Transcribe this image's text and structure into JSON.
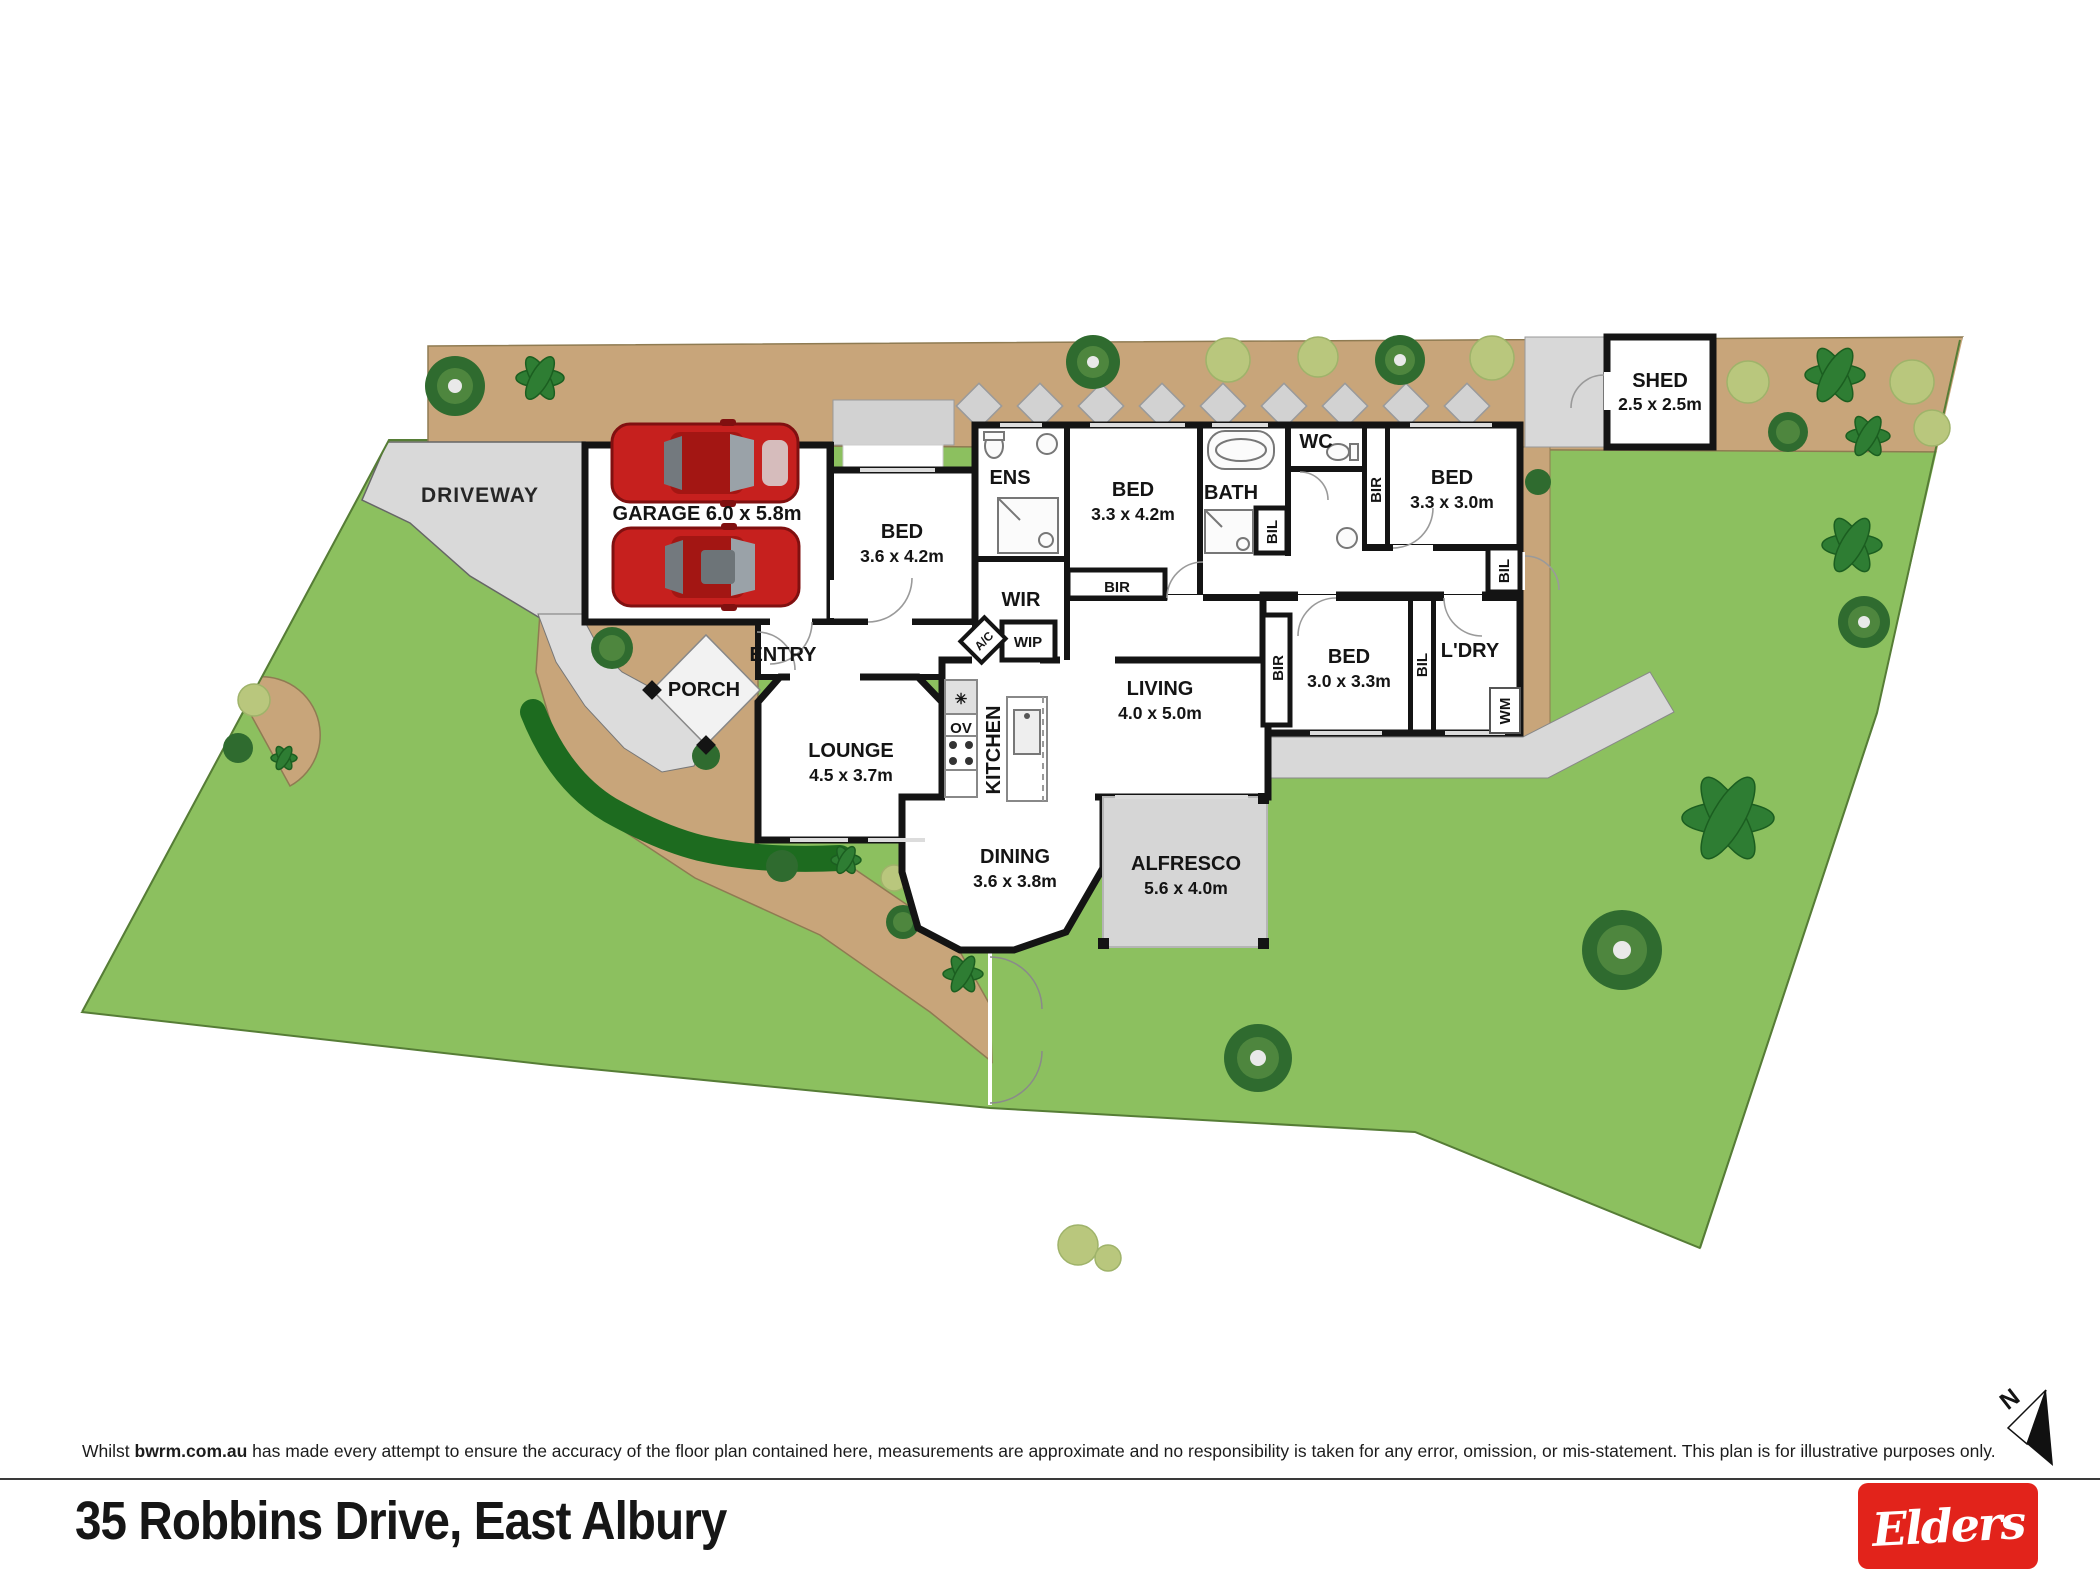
{
  "site": {
    "driveway_label": "DRIVEWAY",
    "colors": {
      "lawn": "#8cc05f",
      "garden_bed": "#c8a57a",
      "paving": "#d9d9d9",
      "alfresco": "#d6d6d6",
      "wall": "#141414",
      "brand_red": "#e2231b"
    }
  },
  "rooms": {
    "garage": {
      "label": "GARAGE 6.0 x 5.8m"
    },
    "porch": {
      "label": "PORCH"
    },
    "entry": {
      "label": "ENTRY"
    },
    "bed1": {
      "name": "BED",
      "dims": "3.6 x 4.2m"
    },
    "ens": {
      "label": "ENS"
    },
    "wir": {
      "label": "WIR"
    },
    "wip": {
      "label": "WIP"
    },
    "ac": {
      "label": "A/C"
    },
    "bed2": {
      "name": "BED",
      "dims": "3.3 x 4.2m"
    },
    "bir_bed2": {
      "label": "BIR"
    },
    "bath": {
      "label": "BATH"
    },
    "bil_bath": {
      "label": "BIL"
    },
    "wc": {
      "label": "WC"
    },
    "bir_bed3": {
      "label": "BIR"
    },
    "bed3": {
      "name": "BED",
      "dims": "3.3 x 3.0m"
    },
    "bil_hall": {
      "label": "BIL"
    },
    "lounge": {
      "name": "LOUNGE",
      "dims": "4.5 x 3.7m"
    },
    "kitchen": {
      "label": "KITCHEN"
    },
    "ov": {
      "label": "OV"
    },
    "living": {
      "name": "LIVING",
      "dims": "4.0 x 5.0m"
    },
    "bir_bed4": {
      "label": "BIR"
    },
    "bed4": {
      "name": "BED",
      "dims": "3.0 x 3.3m"
    },
    "bil_ldry": {
      "label": "BIL"
    },
    "ldry": {
      "label": "L'DRY"
    },
    "wm": {
      "label": "WM"
    },
    "dining": {
      "name": "DINING",
      "dims": "3.6 x 3.8m"
    },
    "alfresco": {
      "name": "ALFRESCO",
      "dims": "5.6 x 4.0m"
    },
    "shed": {
      "name": "SHED",
      "dims": "2.5 x 2.5m"
    }
  },
  "footer": {
    "disclaimer_prefix": "Whilst ",
    "disclaimer_brand": "bwrm.com.au",
    "disclaimer_suffix": " has made every attempt to ensure the accuracy of the floor plan contained here, measurements are approximate and no responsibility is taken for any error, omission, or mis-statement. This plan is for illustrative purposes only.",
    "address": "35 Robbins Drive, East Albury",
    "brand": "Elders",
    "north_label": "N"
  }
}
